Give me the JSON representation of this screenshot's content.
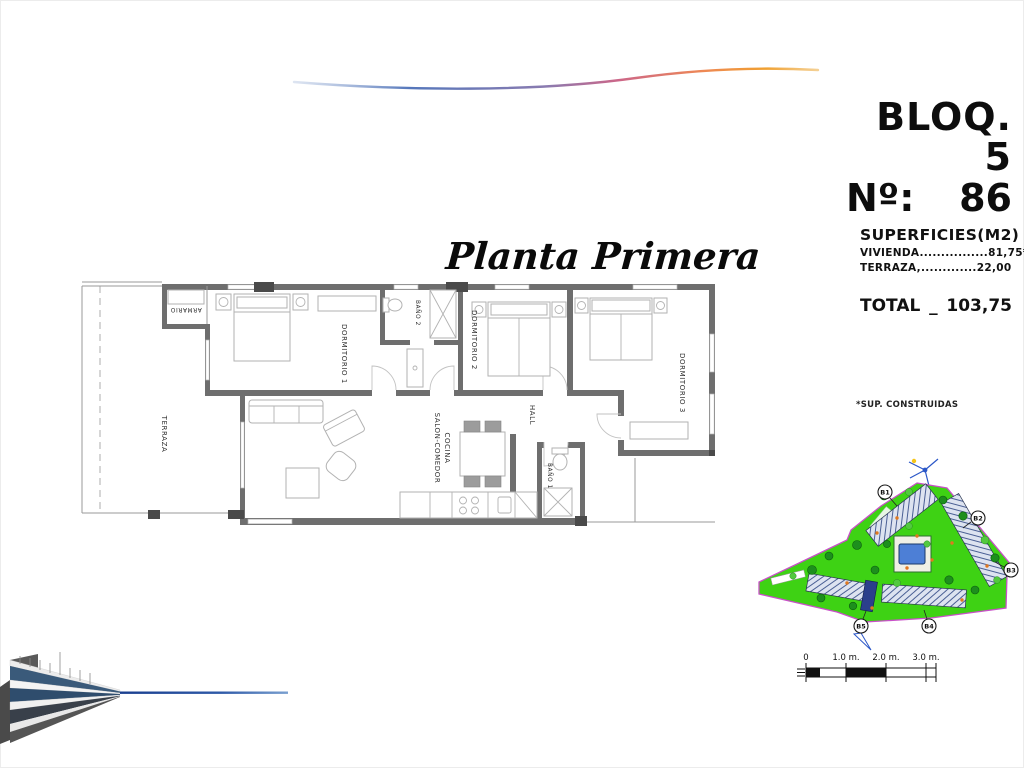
{
  "header": {
    "block_label": "BLOQ. 5",
    "unit_label": "Nº:",
    "unit_number": "86"
  },
  "plan_title": "Planta Primera",
  "surfaces": {
    "heading": "SUPERFICIES(M2)",
    "rows": [
      {
        "label": "VIVIENDA",
        "dots": "................",
        "value": "81,75*"
      },
      {
        "label": "TERRAZA,",
        "dots": ".............",
        "value": "22,00"
      }
    ],
    "total_label": "TOTAL",
    "total_separator": "_",
    "total_value": "103,75",
    "footnote": "*SUP. CONSTRUIDAS"
  },
  "floorplan": {
    "rooms": [
      {
        "label": "TERRAZA"
      },
      {
        "label": "ARMARIO"
      },
      {
        "label": "DORMITORIO 1"
      },
      {
        "label": "BAÑO 2"
      },
      {
        "label": "DORMITORIO 2"
      },
      {
        "label": "DORMITORIO 3"
      },
      {
        "label": "HALL"
      },
      {
        "label": "SALON-COMEDOR"
      },
      {
        "label": "COCINA"
      },
      {
        "label": "BAÑO 1"
      }
    ]
  },
  "siteplan": {
    "block_labels": [
      "B1",
      "B2",
      "B3",
      "B4",
      "B5"
    ]
  },
  "scalebar": {
    "ticks": [
      "0",
      "1.0 m.",
      "2.0 m.",
      "3.0 m."
    ]
  },
  "colors": {
    "site_green": "#3ed214",
    "site_border": "#c850c8",
    "pool_blue": "#4d7fd6",
    "highlight_blue": "#2b3f8c",
    "swoosh_blue": "#5577bb",
    "swoosh_orange": "#f0a030"
  }
}
